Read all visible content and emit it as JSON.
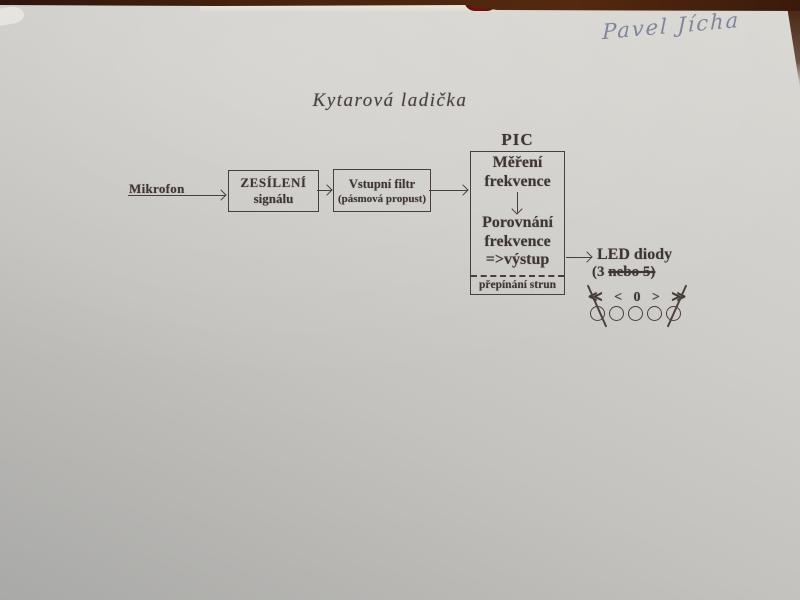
{
  "photo": {
    "handwritten_name": "Pavel Jícha"
  },
  "diagram": {
    "title": "Kytarová ladička",
    "microphone_label": "Mikrofon",
    "amplifier": {
      "line1": "ZESÍLENÍ",
      "line2": "signálu"
    },
    "filter": {
      "line1": "Vstupní filtr",
      "line2": "(pásmová propust)"
    },
    "pic": {
      "label": "PIC",
      "measure_line1": "Měření",
      "measure_line2": "frekvence",
      "compare_line1": "Porovnání",
      "compare_line2": "frekvence",
      "compare_line3": "=>výstup",
      "footer": "přepínání strun"
    },
    "led": {
      "title": "LED diody",
      "note_prefix": "(3 ",
      "note_struck": "nebo 5)",
      "symbols": [
        "≪",
        "<",
        "0",
        ">",
        "≫"
      ],
      "count": 5,
      "crossed_out_indices": [
        0,
        4
      ]
    }
  },
  "colors": {
    "paper": "#cbc9c5",
    "background_brown": "#3f1f12",
    "ink": "#3e3631",
    "handwriting_ink": "#6b7490",
    "red_object": "#6e190d"
  }
}
